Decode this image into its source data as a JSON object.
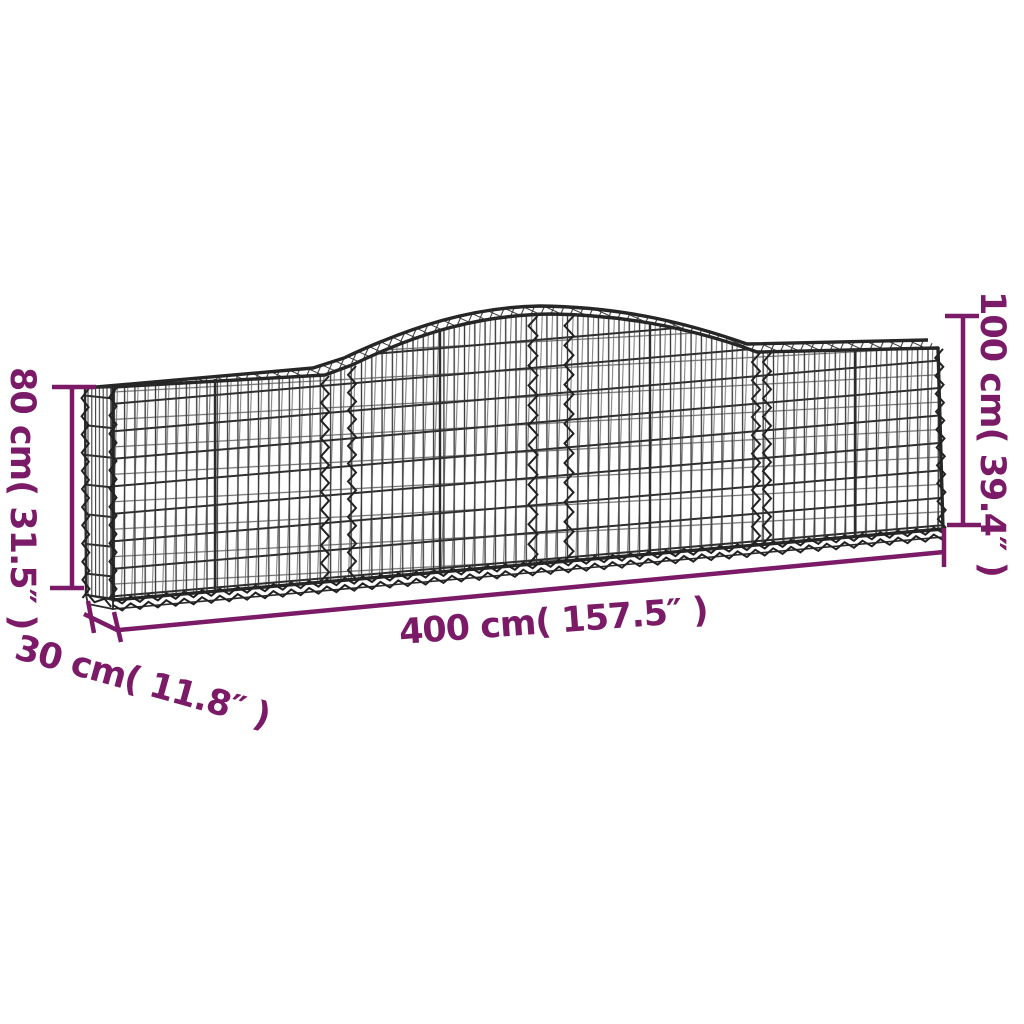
{
  "diagram": {
    "kind": "product-dimension-diagram",
    "product": "arched gabion mesh basket",
    "labels": {
      "height_left": "80 cm( 31.5″ )",
      "depth": "30 cm( 11.8″ )",
      "length": "400 cm( 157.5″ )",
      "height_right": "100 cm( 39.4″ )"
    },
    "colors": {
      "annotation": "#7b1b67",
      "wire": "#2c2c2c",
      "background": "#ffffff"
    }
  }
}
